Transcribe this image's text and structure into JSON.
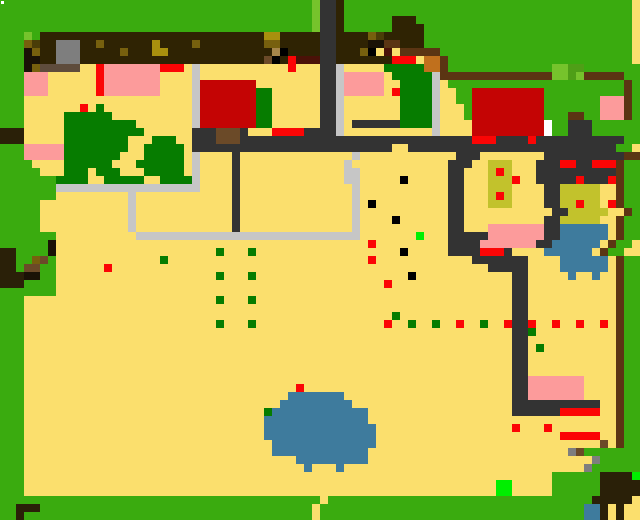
{
  "map": {
    "cols": 80,
    "rows": 65,
    "cell_size": 8,
    "palette": {
      ".": "#fbdf6d",
      "G": "#3aab0f",
      "g": "#067c00",
      "l": "#76c32c",
      "m": "#4f9f17",
      "L": "#00ef00",
      "D": "#333333",
      "B": "#2f2303",
      "F": "#5b3513",
      "s": "#c6c6c6",
      "A": "#7e7e7e",
      "T": "#5e4c3c",
      "K": "#000000",
      "k": "#1a1206",
      "o": "#77600e",
      "O": "#4a3d08",
      "Y": "#a9900e",
      "y": "#c2c22c",
      "R": "#fb0505",
      "M": "#4a1208",
      "C": "#c40404",
      "P": "#fc9b9b",
      "W": "#ffffff",
      "N": "#3e7b9d",
      "q": "#c0701d",
      "b": "#6b4a28",
      "t": "#a5854a",
      "E": "#2a2008"
    },
    "grid": [
      "GGGGGGGGGGGGGGGGGGGGGGGGGGGGGGGGGGGGGGGlDDBGGGGGGGGGGGGGGGGGGGGGGGGGGGGGGGGGGGG",
      "GGGGGGGGGGGGGGGGGGGGGGGGGGGGGGGGGGGGGGGlDDBGGGGGGGGGGGGGGGGGGGGGGGGGGGGGGGGGGGG",
      "GGGGGGGGGGGGGGGGGGGGGGGGGGGGGGGGGGGGGGGlDDBGGGGGGBBBGGGGGGGGGGGGGGGGGGGGGGGGGGG",
      "GGGGGGGGGGGGGGGGGGGGGGGGGGGGGGGGGGGGGGGlDDBGGGGGGBBBBGGGGGGGGGGGGGGGGGGGGGGGGGG",
      "GGGlGBBBBBBBBBBBBBBBBBBBBBBBBBBBBYYBBBBBDDBBBBoOBBBBBGGGGGGGGGGGGGGGGGGGGGGGGGG",
      "GGGoOBBAAABBoBBBBBBYBBBBoBBBBBBBBooBBBBBDDBBBBkkFFBBBGGGGGGGGGGGGGGGGGGGGGGGGGG",
      "GGGkoBBAAABBBBBoBBBYYBBBBBBBBBBBBBtKBBBBDDBBBoK.M.FFFFFGGGGGGGGGGGGGGGGGGGGGGGG",
      "GGGkkBBAAABBBBBBBBBBBBBBBBBBBBBBBbKBRMMMDDBBBBBBBRRR.qqFGGGGGGGGGGGGGGGGGGGGGGG",
      "GGGkoTTTTT..RPPPPPPPRRR.s...........R...DDs.....gggggqqFGGGGGGGGGGGGGllmmGGGGGGG",
      "GGGPPP......RPPPPPPP....s...............DDsPPPPP.gggggsFFFFFFFFFFFFFFllmlFFFFFGG",
      "GGGPPP......RPPPPPPP....sCCCCCCC........DDsPPPPP..ggggs.GGGGGGGGGGGGGGGGGGGGGGFG",
      "GGGPPP......RPPPPPPP....sCCCCCCCgg......DDsPPPPP.Rggggs..GGCCCCCCCCCGGGGGGGGGGFG",
      "GGG.....................sCCCCCCCgg......DDs.......ggggs..GGCCCCCCCCCGGGGGGGPPPFG",
      "GGG.......R.g...........sCCCCCCCgg......DDs.......ggggs...GCCCCCCCCCGGGGGGGPPPFG",
      "GGG.....gggggg..........sCCCCCCCgg......DDs.......ggggs...GCCCCCCCCCGGGFFGGPPPFG",
      "GGG.....ggggggggg.......sCCCCCCCgg......DDs.DDDDDDggggs....CCCCCCCCCWGGDDDGGGGGG",
      "EEE.....gggggggggg......DDDbbbD...RRRRDDDDs...........s....CCCCCCCCCWGGDDDGGGGGG",
      "EEE.....gggggggg...ggg..DDDbbbDDDDDDDDDDDDDDDDDDDDDDDDDDDDDRRRDDDDRDDDDDDDDDDDGG",
      "GGGPPPPPgggggggg..ggggg.DDDDDDDDDDDDDDDDDDDDDDDDD..DDDDDDDDDDDDDDDDDDDDDDDDDDGG",
      "GGGPPPPPggggggg...ggggg.s....D..............s............DDD........DDDDDDDDDDFFF",
      "GGGG....gggggg...gggggg.s....D.............s............DDD..yyy...DDDRRDDRRRFGG",
      "GGGGG...ggg.ggg...ggggg.s....D.............ss...........DD...yRy...DDDDDDDDDDFGG",
      "GGGGGGGgggg..ggggg..ggggs....D.............ss.....K.....DD...yyyR..DDDDDRDDDRFGG",
      "GGGGGGGssssssssssssssssss....D..............s...........DD...yyy....DDyyyyy..FGG",
      "GGGGGGG.........s............D..............s...........DD...yRy....DDyyyyy..FGG",
      "GGGGG...........s............D..............s.K.........DD...yyy....DDyyRyy.RFGG",
      "GGGGG...........s............D..............s...........DD...........DDyyyyy..FGG",
      "GGGGG...........s............D..............s....K......DD..........DDyyyyy..FGG",
      "GGGGG...........s............D..............s...........DD...PPPPPPPDDNNNNNN.FGG",
      "GGGGGGG..........ssssssssssssssssssssssssssss.......L...DDDDDPPPPPPPDDNNNNNN.FGG",
      "GGGGGGk.......................................R.........DDDDPPPPPPPDDNNNNNN.FGG",
      "EEGGGGk....................g...g..................K.....DDDDRRRD....NNNNNN.FGG",
      "EEGGobG.............g.........................R............DDDDDDD....NNNNNN.FGG",
      "EEGbbGG......R...............................................DDDDD....NNNNNN.FGG",
      "EEEkkGG....................g...g...................K............DD.....N..N..FGG",
      "EEEGGGG.........................................R...............DD...........FGG",
      "GGGGGGG.........................................................DD...........FGG",
      "GGG........................g...g................................DD...........FGG",
      "GGG.............................................................DD...........FGG",
      "GGG..............................................g..............DD...........FGG",
      "GGG........................g...g................R..g..g..R..g..RDDR..R..R..R.FGG",
      "GGG.............................................................DDg..........FGG",
      "GGG.............................................................DD...........FGG",
      "GGG.............................................................DD.g.........FGG",
      "GGG.............................................................DD...........FGG",
      "GGG.............................................................DD...........FGG",
      "GGG.............................................................DD...........FGG",
      "GGG.............................................................DDPPPPPPP....FGG",
      "GGG..................................R..........................DDPPPPPPP....FGG",
      "GGG.................................NNNNNNN.....................DDPPPPPPP....FGG",
      "GGG................................NNNNNNNNN....................DDDDDDDDDDD..FGG",
      "GGG..............................gNNNNNNNNNNNN..................DDDDDDRRRRR..FGG",
      "GGG..............................NNNNNNNNNNNNN...............................FGG",
      "GGG..............................NNNNNNNNNNNNNN.................R...R........FGG",
      "GGG..............................NNNNNNNNNNNNNN.......................RRRRR..FGG",
      "GGG...............................NNNNNNNNNNNNN............................b.FGG",
      "GGG...............................NNNNNNNNNNNN.........................AbGGGGGGG",
      "GGG..................................NNNNNNNNN............................AGGGGGGG",
      "GGG...................................N...N..............................AGGGGGGG",
      "GGG..................................................................GGGGGGEEEEL",
      "GGG...........................................................LL.....GGGGGGEEEEE",
      "GGG...........................................................LL.....GGGGGGEEEEE",
      "GGGGGGGGGGGGGGGGGGGGGGGGGGGGGGGGGGGGGGGG.GGGGGGGGGGGGGGGGGGGGGGGGGGGGGGGGGEEEEE",
      "GGEEEGGGGGGGGGGGGGGGGGGGGGGGGGGGGGGGGGG.GGGGGGGGGGGGGGGGGGGGGGGGGGGGGGGGGNNE.E",
      "GGEGGGGGGGGGGGGGGGGGGGGGGGGGGGGGGGGGGGG.GGGGGGGGGGGGGGGGGGGGGGGGGGGGGGGGGNNE.E"
    ],
    "overlays": [
      {
        "name": "corner-dot",
        "x": 1,
        "y": 1,
        "w": 3,
        "h": 3,
        "color": "#ffffff"
      }
    ]
  }
}
